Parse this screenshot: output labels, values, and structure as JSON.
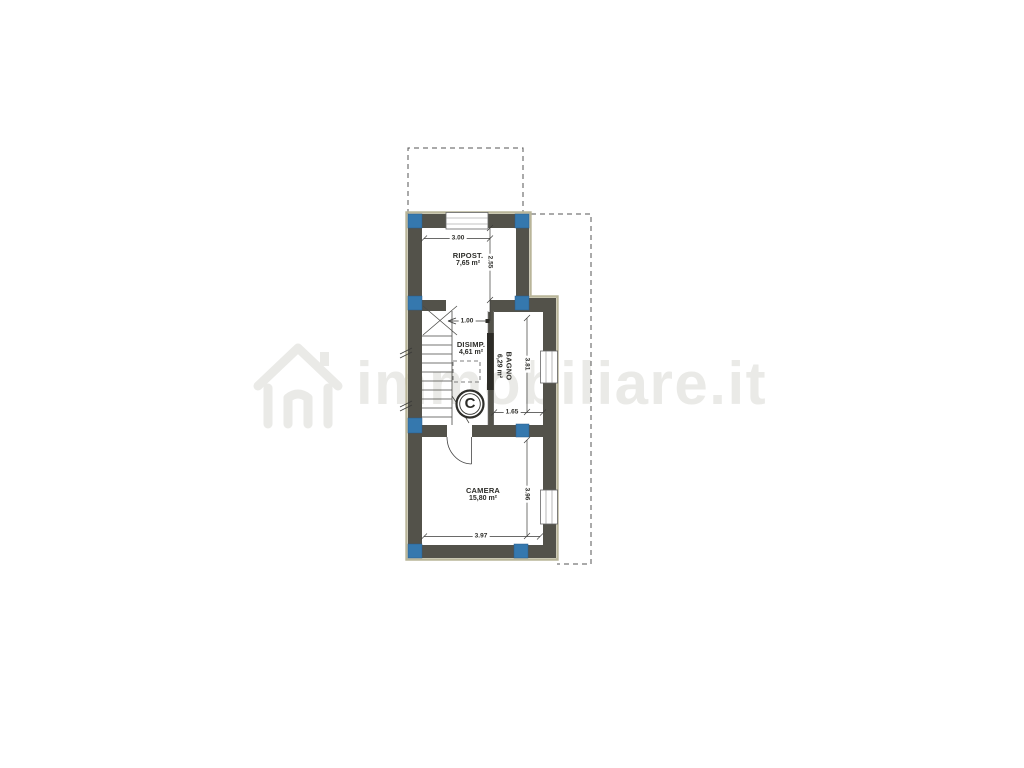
{
  "watermark": {
    "text": "immobiliare.it"
  },
  "rooms": {
    "ripost": {
      "name": "RIPOST.",
      "area": "7,65 m²"
    },
    "disimp": {
      "name": "DISIMP.",
      "area": "4,61 m²"
    },
    "bagno": {
      "name": "BAGNO",
      "area": "6,29 m²"
    },
    "camera": {
      "name": "CAMERA",
      "area": "15,80 m²"
    }
  },
  "stair": {
    "label": "C"
  },
  "dimensions": {
    "ripost_width": "3.00",
    "ripost_depth": "2.55",
    "landing_width": "1.00",
    "bagno_depth": "3.81",
    "bagno_width": "1.65",
    "camera_depth": "3.96",
    "camera_width": "3.97"
  },
  "colors": {
    "wall": "#53524a",
    "outer_outline": "#b9b599",
    "column_blue": "#3578ae",
    "linework": "#3a3a38",
    "watermark_gray": "#eaeae7"
  }
}
